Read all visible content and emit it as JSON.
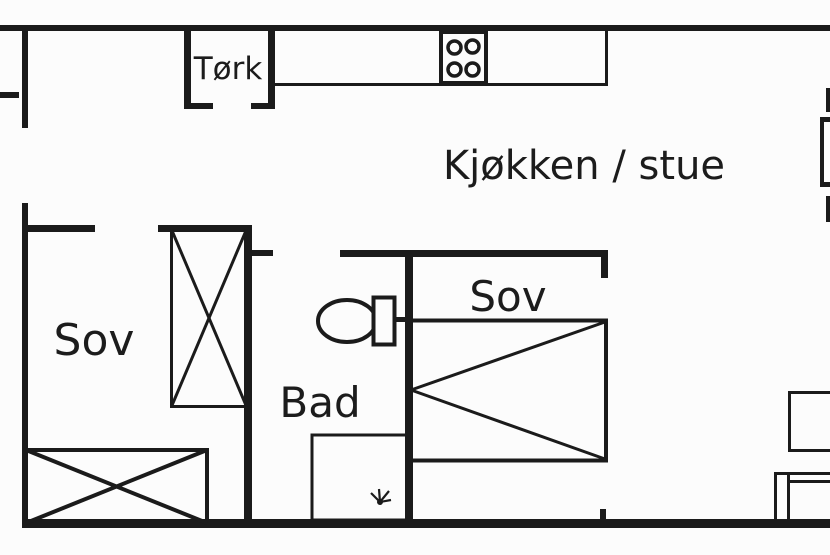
{
  "floorplan": {
    "rooms": {
      "drying": {
        "label": "Tørk"
      },
      "kitchen_living": {
        "label": "Kjøkken / stue"
      },
      "bedroom_left": {
        "label": "Sov"
      },
      "bedroom_right": {
        "label": "Sov"
      },
      "bathroom": {
        "label": "Bad"
      }
    },
    "fixtures": [
      "stove-burners-icon",
      "toilet-icon",
      "shower-drain-icon",
      "wardrobe-crossed-box",
      "bed-crossed-box",
      "bed-triangle-box",
      "side-table",
      "sofa-cut-off"
    ],
    "colors": {
      "line": "#1b1b1b",
      "background": "#fcfcfc"
    }
  }
}
